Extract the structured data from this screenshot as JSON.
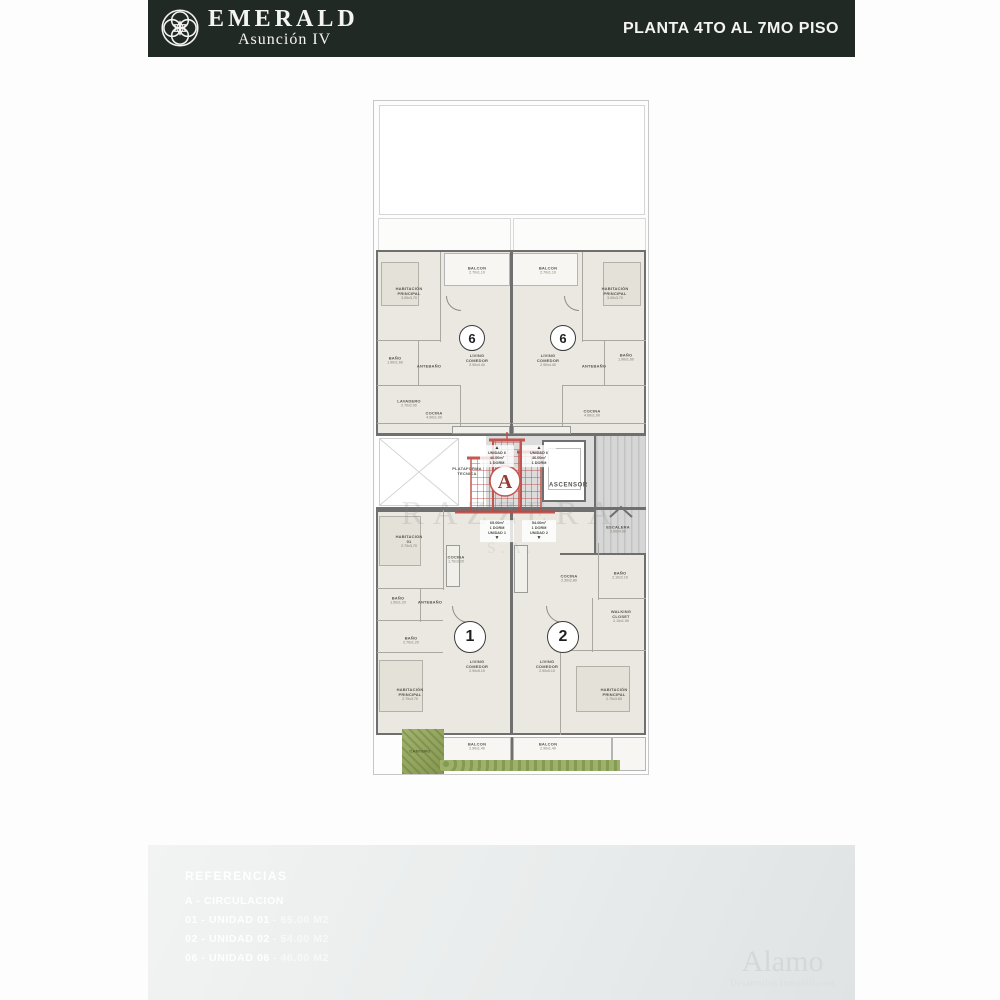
{
  "header": {
    "brand_name": "EMERALD",
    "brand_sub": "Asunción IV",
    "plate": "PLANTA 4TO AL 7MO PISO",
    "bg_color": "#212925"
  },
  "plan": {
    "rooms": [
      {
        "name": "HABITACIÓN PRINCIPAL",
        "dims": "3.00x3.70",
        "x": 409,
        "y": 293
      },
      {
        "name": "BALCON",
        "dims": "2.70x1.10",
        "x": 477,
        "y": 270
      },
      {
        "name": "BAÑO",
        "dims": "1.90x1.60",
        "x": 395,
        "y": 360
      },
      {
        "name": "ANTEBAÑO",
        "dims": "",
        "x": 429,
        "y": 366
      },
      {
        "name": "LAVADERO",
        "dims": "2.70x2.00",
        "x": 409,
        "y": 403
      },
      {
        "name": "COCINA",
        "dims": "4.00x1.00",
        "x": 434,
        "y": 415
      },
      {
        "name": "LIVING COMEDOR",
        "dims": "2.90x4.40",
        "x": 477,
        "y": 360
      },
      {
        "name": "BALCON",
        "dims": "2.70x1.10",
        "x": 548,
        "y": 270
      },
      {
        "name": "HABITACIÓN PRINCIPAL",
        "dims": "3.00x3.70",
        "x": 615,
        "y": 293
      },
      {
        "name": "LIVING COMEDOR",
        "dims": "2.90x4.40",
        "x": 548,
        "y": 360
      },
      {
        "name": "BAÑO",
        "dims": "1.90x1.60",
        "x": 626,
        "y": 357
      },
      {
        "name": "ANTEBAÑO",
        "dims": "",
        "x": 594,
        "y": 366
      },
      {
        "name": "COCINA",
        "dims": "4.00x1.00",
        "x": 592,
        "y": 413
      },
      {
        "name": "PLATAFORMA TECNICA",
        "dims": "",
        "x": 467,
        "y": 471
      },
      {
        "name": "ASCENSOR",
        "dims": "",
        "major": true,
        "x": 564,
        "y": 486
      },
      {
        "name": "ESCALERA",
        "dims": "2.60x4.90",
        "x": 618,
        "y": 529
      },
      {
        "name": "HABITACION 01",
        "dims": "2.70x3.70",
        "x": 409,
        "y": 541
      },
      {
        "name": "COCINA",
        "dims": "1.70x3.20",
        "x": 456,
        "y": 559
      },
      {
        "name": "BAÑO",
        "dims": "1.50x1.20",
        "x": 398,
        "y": 600
      },
      {
        "name": "ANTEBAÑO",
        "dims": "",
        "x": 430,
        "y": 602
      },
      {
        "name": "BAÑO",
        "dims": "2.70x1.20",
        "x": 411,
        "y": 640
      },
      {
        "name": "LIVING COMEDOR",
        "dims": "2.90x5.10",
        "x": 477,
        "y": 666
      },
      {
        "name": "HABITACIÓN PRINCIPAL",
        "dims": "2.70x3.70",
        "x": 410,
        "y": 694
      },
      {
        "name": "COCINA",
        "dims": "2.30x2.80",
        "x": 569,
        "y": 578
      },
      {
        "name": "BAÑO",
        "dims": "2.10x2.10",
        "x": 620,
        "y": 575
      },
      {
        "name": "WALKING CLOSET",
        "dims": "2.10x1.90",
        "x": 621,
        "y": 616
      },
      {
        "name": "LIVING COMEDOR",
        "dims": "2.90x5.10",
        "x": 547,
        "y": 666
      },
      {
        "name": "HABITACIÓN PRINCIPAL",
        "dims": "2.70x3.60",
        "x": 614,
        "y": 694
      },
      {
        "name": "CANTERO",
        "dims": "",
        "green": true,
        "x": 420,
        "y": 751
      },
      {
        "name": "BALCON",
        "dims": "2.90x1.40",
        "x": 477,
        "y": 746
      },
      {
        "name": "BALCON",
        "dims": "2.90x1.40",
        "x": 548,
        "y": 746
      }
    ],
    "badges": [
      {
        "num": "6",
        "x": 472,
        "y": 338,
        "d": 24,
        "fs": 13
      },
      {
        "num": "6",
        "x": 563,
        "y": 338,
        "d": 24,
        "fs": 13
      },
      {
        "num": "1",
        "x": 470,
        "y": 637,
        "d": 30,
        "fs": 16
      },
      {
        "num": "2",
        "x": 563,
        "y": 637,
        "d": 30,
        "fs": 16
      }
    ],
    "info_blocks": [
      {
        "x": 497,
        "y": 456,
        "dir": "up",
        "lines": [
          "UNIDAD 6",
          "46.00m²",
          "1 DORM"
        ]
      },
      {
        "x": 539,
        "y": 456,
        "dir": "up",
        "lines": [
          "UNIDAD 6",
          "46.00m²",
          "1 DORM"
        ]
      },
      {
        "x": 497,
        "y": 531,
        "dir": "down",
        "lines": [
          "65.00m²",
          "1 DORM",
          "UNIDAD 1"
        ]
      },
      {
        "x": 539,
        "y": 531,
        "dir": "down",
        "lines": [
          "54.00m²",
          "1 DORM",
          "UNIDAD 2"
        ]
      }
    ],
    "watermark": {
      "text": "RAZZERA",
      "sub": "S.A.",
      "logo_letter": "A",
      "logo_color": "#bf4a45"
    }
  },
  "footer": {
    "title": "REFERENCIAS",
    "items": [
      {
        "label": "A - CIRCULACION",
        "value": ""
      },
      {
        "label": "01 - UNIDAD 01",
        "value": "- 65.00 M2"
      },
      {
        "label": "02 - UNIDAD 02",
        "value": "- 54.00 M2"
      },
      {
        "label": "06 - UNIDAD 06",
        "value": "- 46.00 M2"
      }
    ],
    "brand_name": "Alamo",
    "brand_sub": "Desarrollos Inmobiliarios"
  }
}
